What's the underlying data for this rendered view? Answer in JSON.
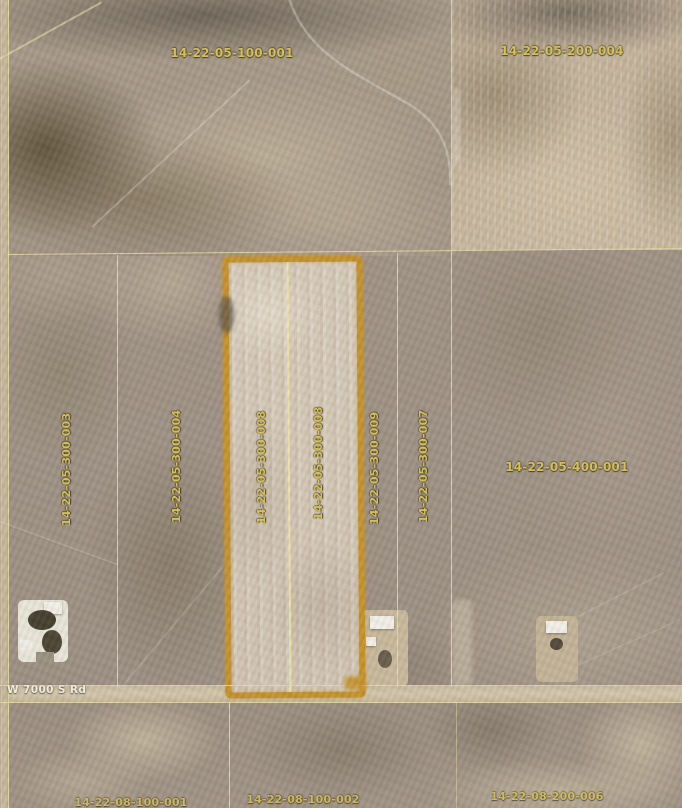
{
  "map": {
    "road_label": "W 7000 S Rd",
    "selected_parcel_id": "14-22-05-300-008",
    "colors": {
      "parcel_line": "#e8dda2",
      "parcel_label": "#d3c059",
      "highlight": "#c6932c",
      "road_label_color": "#efeadd"
    }
  },
  "parcel_labels": [
    {
      "id": "14-22-05-100-001"
    },
    {
      "id": "14-22-05-200-004"
    },
    {
      "id": "14-22-05-300-003"
    },
    {
      "id": "14-22-05-300-004"
    },
    {
      "id": "14-22-05-300-008"
    },
    {
      "id": "14-22-05-300-008"
    },
    {
      "id": "14-22-05-300-009"
    },
    {
      "id": "14-22-05-300-007"
    },
    {
      "id": "14-22-05-400-001"
    },
    {
      "id": "14-22-08-100-001"
    },
    {
      "id": "14-22-08-100-002"
    },
    {
      "id": "14-22-08-200-006"
    }
  ]
}
